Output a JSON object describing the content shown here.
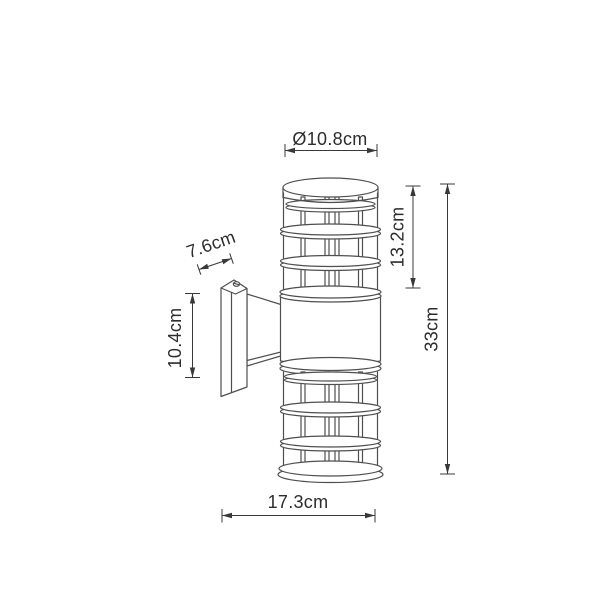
{
  "drawing": {
    "description": "Technical dimension drawing of a cylindrical up/down wall lamp with caged lantern sections and a wall mounting bracket",
    "colors": {
      "background": "#ffffff",
      "outline": "#4f4f4f",
      "dimension_line": "#383838",
      "label_text": "#2d2d2d"
    },
    "dimensions": {
      "top_diameter": "Ø10.8cm",
      "upper_section_height": "13.2cm",
      "total_height": "33cm",
      "bracket_plate_height": "10.4cm",
      "bracket_depth": "7.6cm",
      "overall_depth": "17.3cm"
    }
  }
}
